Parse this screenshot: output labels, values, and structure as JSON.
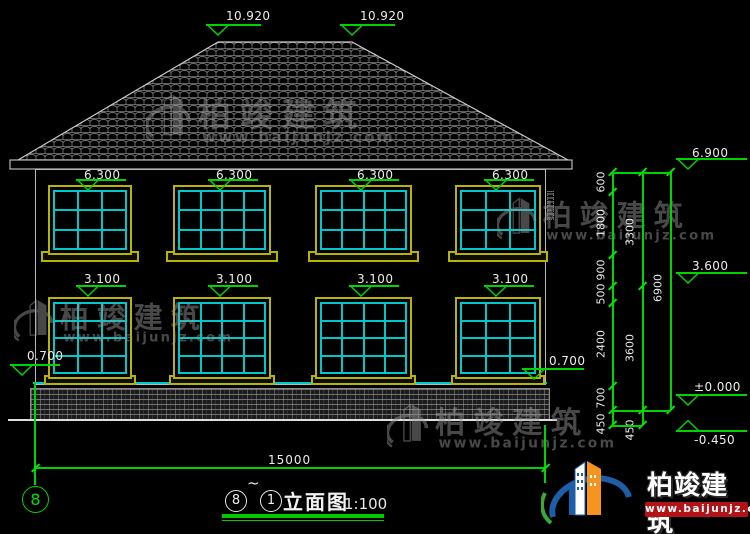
{
  "title": {
    "left_ref": "8",
    "tilde": "~",
    "right_ref": "1",
    "name": "立面图",
    "scale": "1:100"
  },
  "axis": {
    "left_bubble": "8"
  },
  "dims": {
    "total_width": "15000"
  },
  "elevation_markers": {
    "labels": [
      "10.920",
      "10.920",
      "6.300",
      "6.300",
      "6.300",
      "6.300",
      "3.100",
      "3.100",
      "3.100",
      "3.100",
      "0.700",
      "0.700",
      "6.900",
      "3.600",
      "±0.000",
      "-0.450"
    ]
  },
  "dim_chains": [
    {
      "values": [
        "600",
        "1800",
        "900",
        "500",
        "2400",
        "700",
        "450"
      ]
    },
    {
      "values": [
        "3300",
        "3600",
        "450"
      ]
    },
    {
      "values": [
        "6900"
      ]
    }
  ],
  "windows": {
    "upper": {
      "cols": [
        3,
        4,
        4,
        3
      ],
      "rows": 3
    },
    "lower": {
      "cols": [
        3,
        4,
        4,
        3
      ],
      "rows": 4
    }
  },
  "watermark": {
    "text": "柏竣建筑",
    "url": "www.baijunjz.com"
  },
  "logo": {
    "text": "柏竣建筑",
    "url": "www.baijunjz.com"
  },
  "colors": {
    "dim_green": "#00d400",
    "frame_yellow": "#b8b400",
    "frame_cyan": "#00c8c8",
    "line_white": "#c8c8c8",
    "text_white": "#e8e8e8",
    "watermark_gray": "#979797",
    "logo_red": "#b31217",
    "logo_blue": "#1c5fa8",
    "logo_orange": "#f7941d",
    "logo_green": "#3aaa35"
  }
}
